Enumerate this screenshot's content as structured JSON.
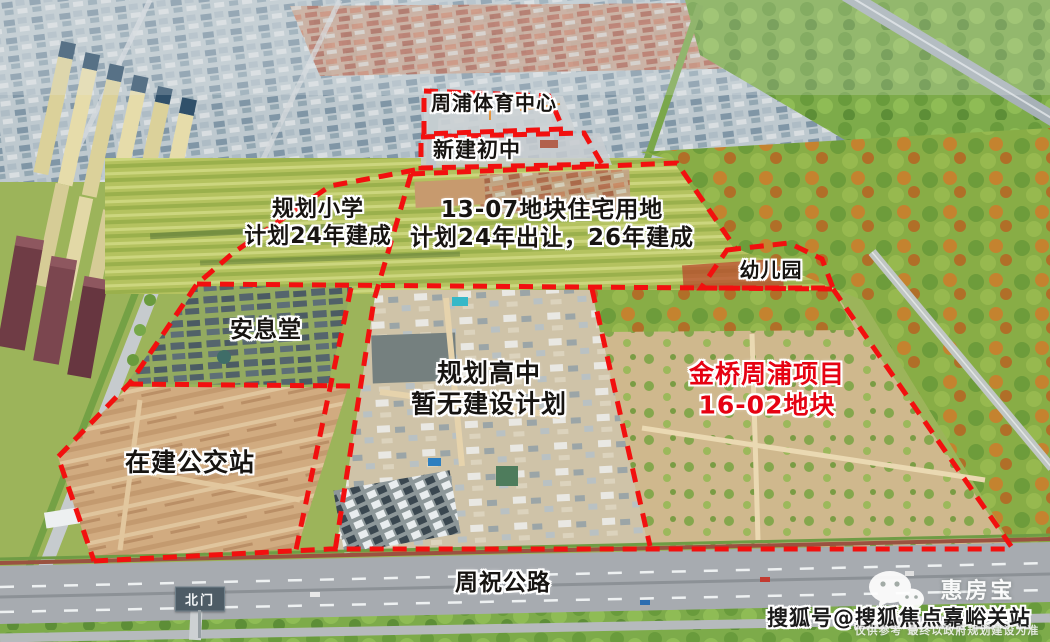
{
  "labels": {
    "sports_center": "周浦体育中心",
    "new_middle_school": "新建初中",
    "planned_primary_1": "规划小学",
    "planned_primary_2": "计划24年建成",
    "plot_13_07_1": "13-07地块住宅用地",
    "plot_13_07_2": "计划24年出让，26年建成",
    "kindergarten": "幼儿园",
    "memorial_hall": "安息堂",
    "planned_high_school_1": "规划高中",
    "planned_high_school_2": "暂无建设计划",
    "project_1": "金桥周浦项目",
    "project_2": "16-02地块",
    "bus_station": "在建公交站",
    "highway": "周祝公路",
    "north_gate": "北门"
  },
  "watermark": {
    "brand": "惠房宝",
    "account": "搜狐号@搜狐焦点嘉峪关站",
    "disclaimer": "仅供参考 最终以政府规划建设为准",
    "logo_icon": "wechat-bubbles-icon"
  },
  "colors": {
    "boundary_red": "#f2100f",
    "label_black": "#171411",
    "label_red": "#e60212",
    "gate_sign_bg": "#4e5c66",
    "watermark_white": "#ffffff"
  }
}
